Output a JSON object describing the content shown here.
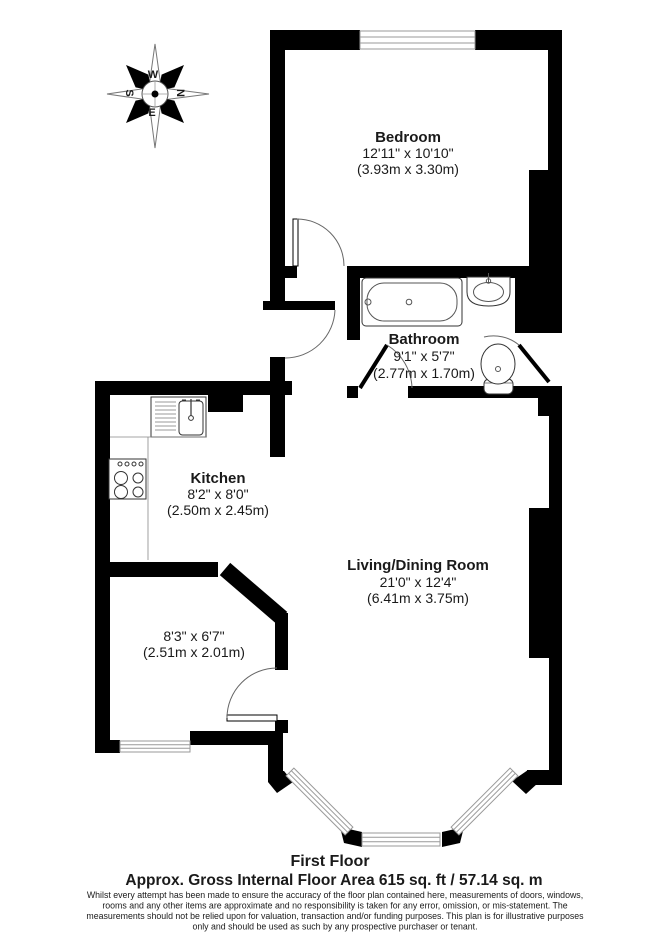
{
  "plan": {
    "compass": {
      "n": "N",
      "e": "E",
      "s": "S",
      "w": "W"
    },
    "rooms": {
      "bedroom": {
        "name": "Bedroom",
        "imperial": "12'11\" x 10'10\"",
        "metric": "(3.93m x 3.30m)"
      },
      "bathroom": {
        "name": "Bathroom",
        "imperial": "9'1\" x 5'7\"",
        "metric": "(2.77m x 1.70m)"
      },
      "kitchen": {
        "name": "Kitchen",
        "imperial": "8'2\" x 8'0\"",
        "metric": "(2.50m x 2.45m)"
      },
      "living": {
        "name": "Living/Dining Room",
        "imperial": "21'0\" x 12'4\"",
        "metric": "(6.41m x 3.75m)"
      },
      "store": {
        "imperial": "8'3\" x 6'7\"",
        "metric": "(2.51m x 2.01m)"
      }
    },
    "fixtures": [
      "bath",
      "basin",
      "toilet",
      "kitchen-sink",
      "hob"
    ]
  },
  "footer": {
    "floor_label": "First Floor",
    "area_line": "Approx. Gross Internal Floor Area 615 sq. ft / 57.14 sq. m",
    "disclaimer_lines": [
      "Whilst every attempt has been made to ensure the accuracy of the floor plan contained here, measurements of doors, windows,",
      "rooms and any other items are approximate and no responsibility is taken for any error, omission, or mis-statement. The",
      "measurements should not be relied upon for valuation, transaction and/or funding purposes. This plan is for illustrative purposes",
      "only and should be used as such by any prospective purchaser or tenant."
    ]
  },
  "colors": {
    "wall": "#000000",
    "background": "#ffffff",
    "fixture_line": "#444444",
    "window_line": "#999999"
  }
}
